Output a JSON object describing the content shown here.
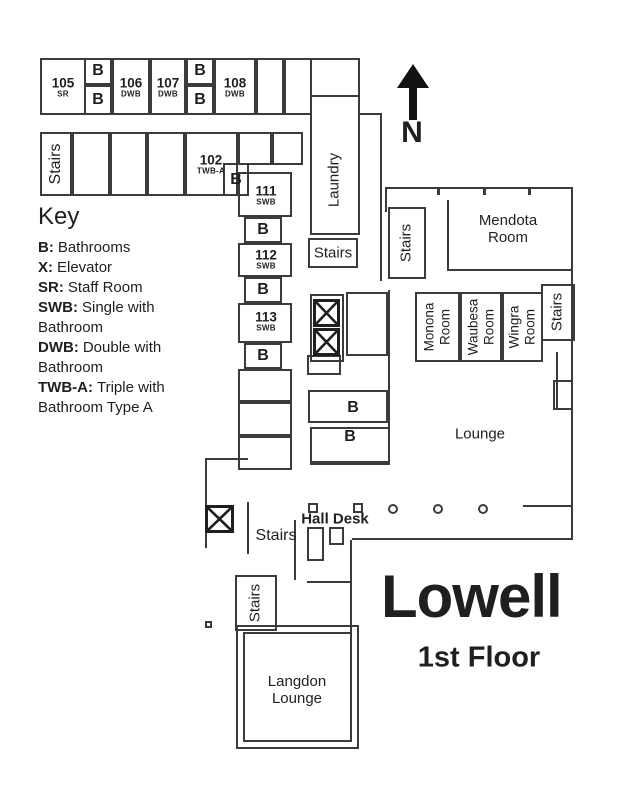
{
  "title": {
    "building": "Lowell",
    "floor": "1st Floor"
  },
  "compass": {
    "north": "N"
  },
  "key": {
    "heading": "Key",
    "entries": [
      {
        "abbr": "B:",
        "desc": "Bathrooms"
      },
      {
        "abbr": "X:",
        "desc": "Elevator"
      },
      {
        "abbr": "SR:",
        "desc": "Staff Room"
      },
      {
        "abbr": "SWB:",
        "desc": "Single with Bathroom"
      },
      {
        "abbr": "DWB:",
        "desc": "Double with Bathroom"
      },
      {
        "abbr": "TWB-A:",
        "desc": "Triple with Bathroom Type A"
      }
    ]
  },
  "rooms": {
    "r105": {
      "num": "105",
      "type": "SR"
    },
    "r106": {
      "num": "106",
      "type": "DWB"
    },
    "r107": {
      "num": "107",
      "type": "DWB"
    },
    "r108": {
      "num": "108",
      "type": "DWB"
    },
    "r102": {
      "num": "102",
      "type": "TWB-A"
    },
    "r111": {
      "num": "111",
      "type": "SWB"
    },
    "r112": {
      "num": "112",
      "type": "SWB"
    },
    "r113": {
      "num": "113",
      "type": "SWB"
    }
  },
  "labels": {
    "stairs": "Stairs",
    "laundry": "Laundry",
    "mendota": "Mendota Room",
    "monona": "Monona Room",
    "waubesa": "Waubesa Room",
    "wingra": "Wingra Room",
    "lounge": "Lounge",
    "hall_desk": "Hall Desk",
    "langdon": "Langdon Lounge",
    "bathroom": "B"
  },
  "colors": {
    "wall": "#3b3b3b",
    "text": "#1f1f1f"
  }
}
